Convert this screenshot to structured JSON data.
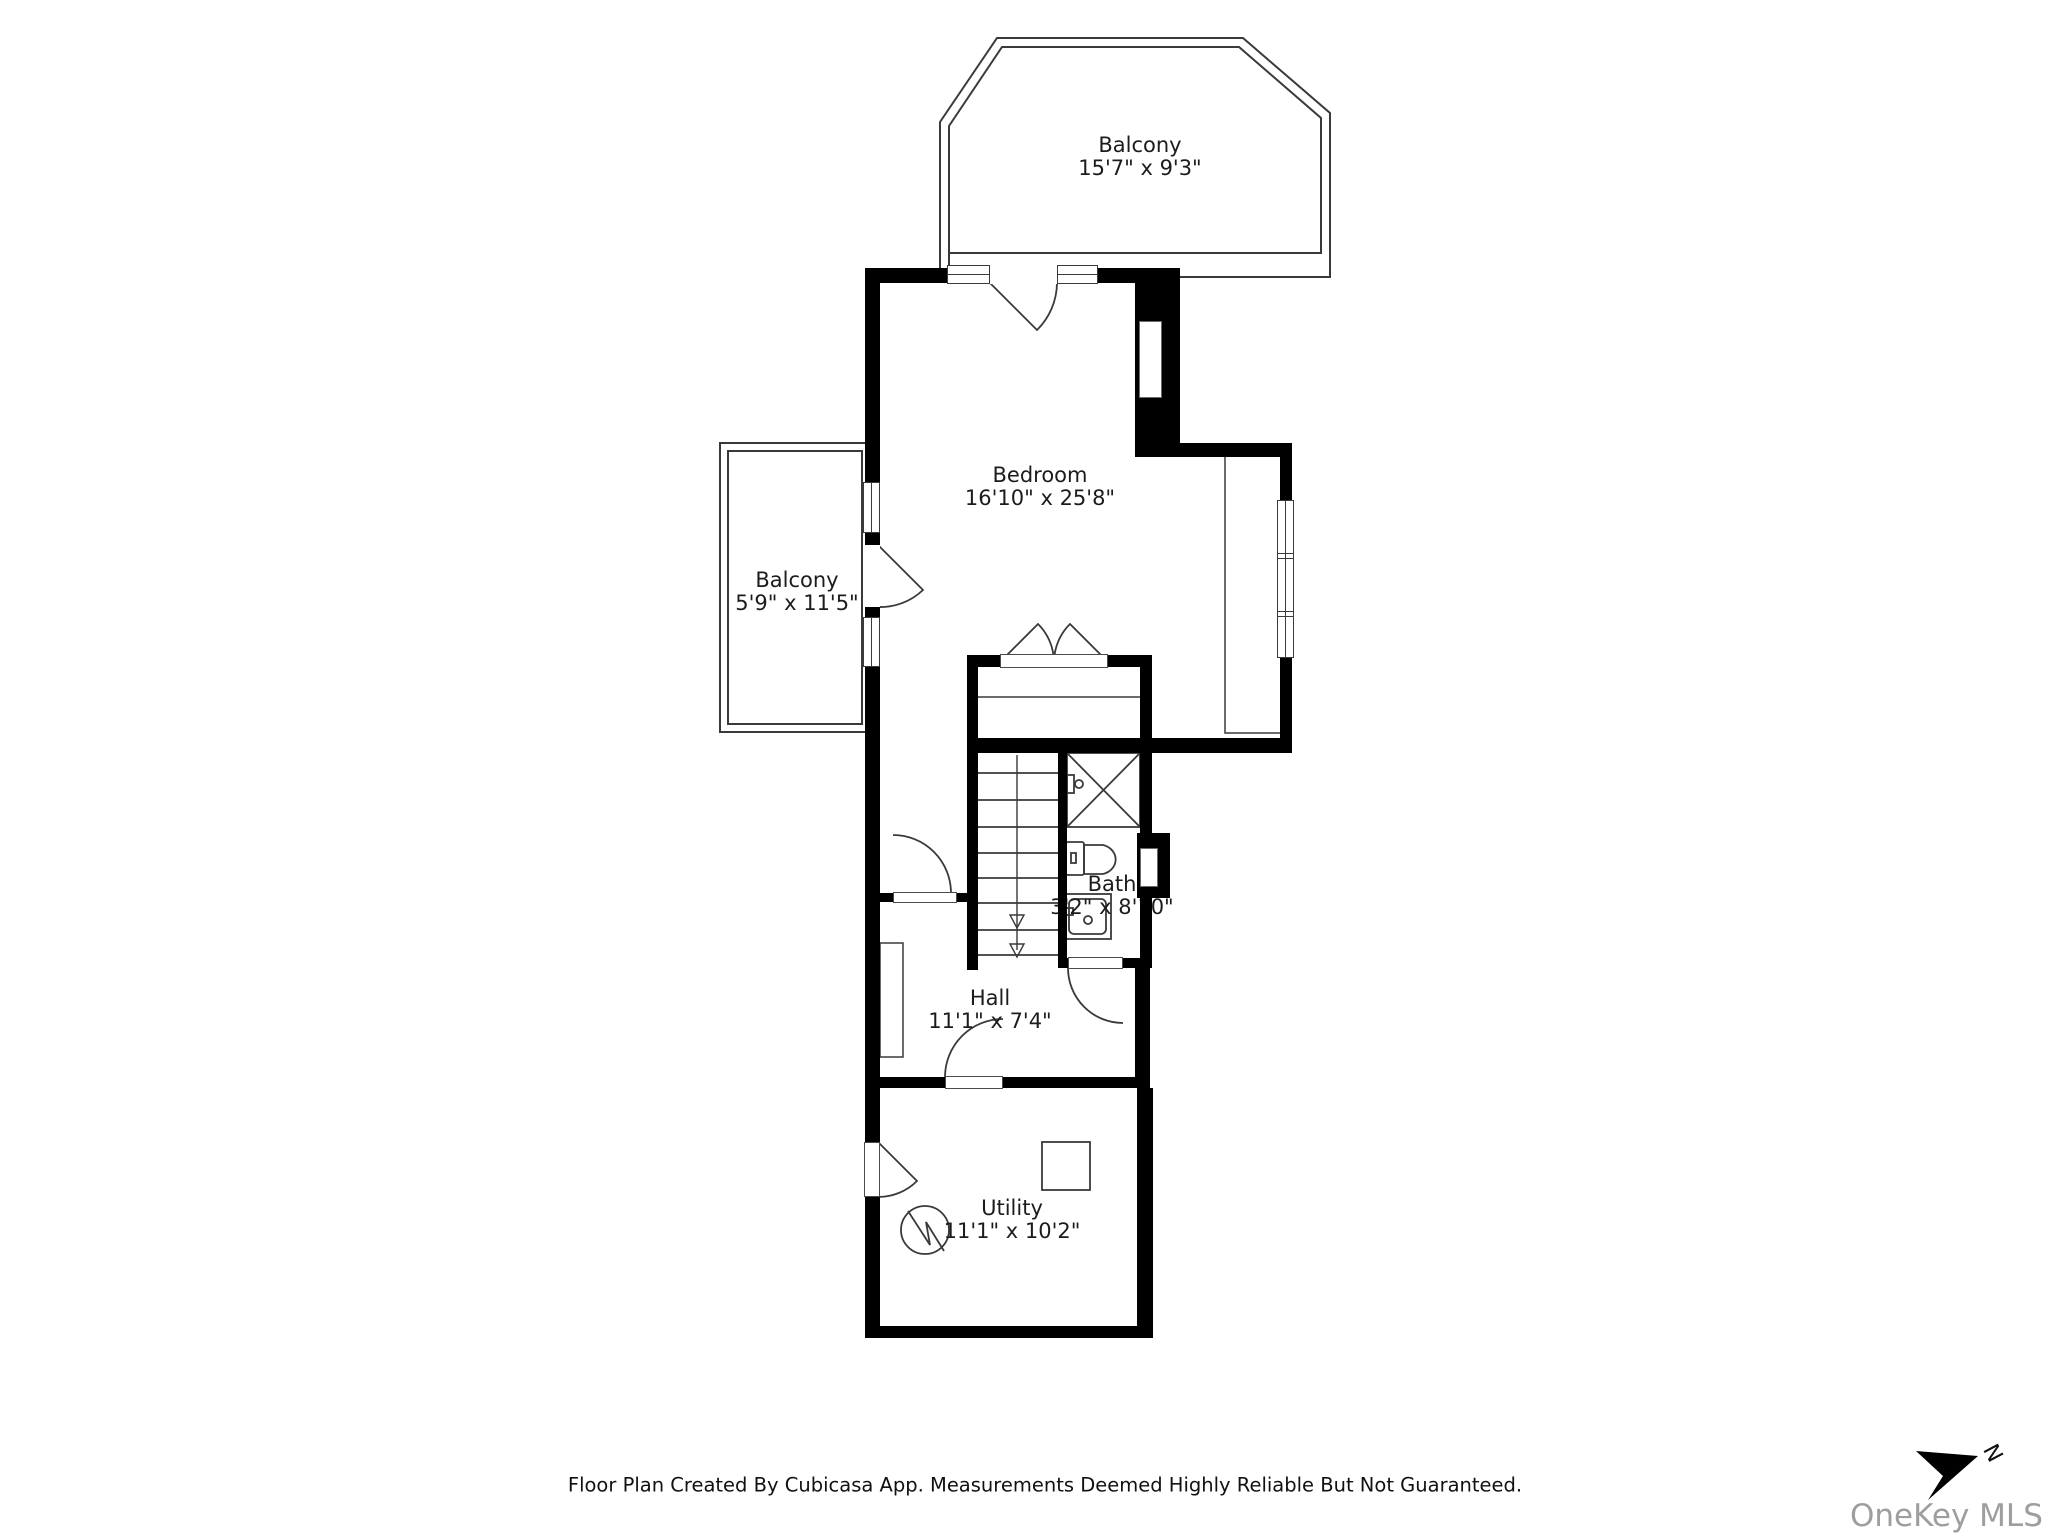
{
  "rooms": {
    "balcony_top": {
      "name": "Balcony",
      "dims": "15'7\" x 9'3\""
    },
    "balcony_left": {
      "name": "Balcony",
      "dims": "5'9\" x 11'5\""
    },
    "bedroom": {
      "name": "Bedroom",
      "dims": "16'10\" x 25'8\""
    },
    "bath": {
      "name": "Bath",
      "dims": "3'2\" x 8'10\""
    },
    "hall": {
      "name": "Hall",
      "dims": "11'1\" x 7'4\""
    },
    "utility": {
      "name": "Utility",
      "dims": "11'1\" x 10'2\""
    }
  },
  "footer": {
    "disclaimer": "Floor Plan Created By Cubicasa App. Measurements Deemed Highly Reliable But Not Guaranteed."
  },
  "watermark": {
    "text": "OneKey MLS"
  },
  "compass": {
    "label": "N"
  },
  "colors": {
    "wall": "#000000",
    "line": "#3a3a3a",
    "text": "#1c1c1c",
    "watermark": "#9e9e9e"
  }
}
